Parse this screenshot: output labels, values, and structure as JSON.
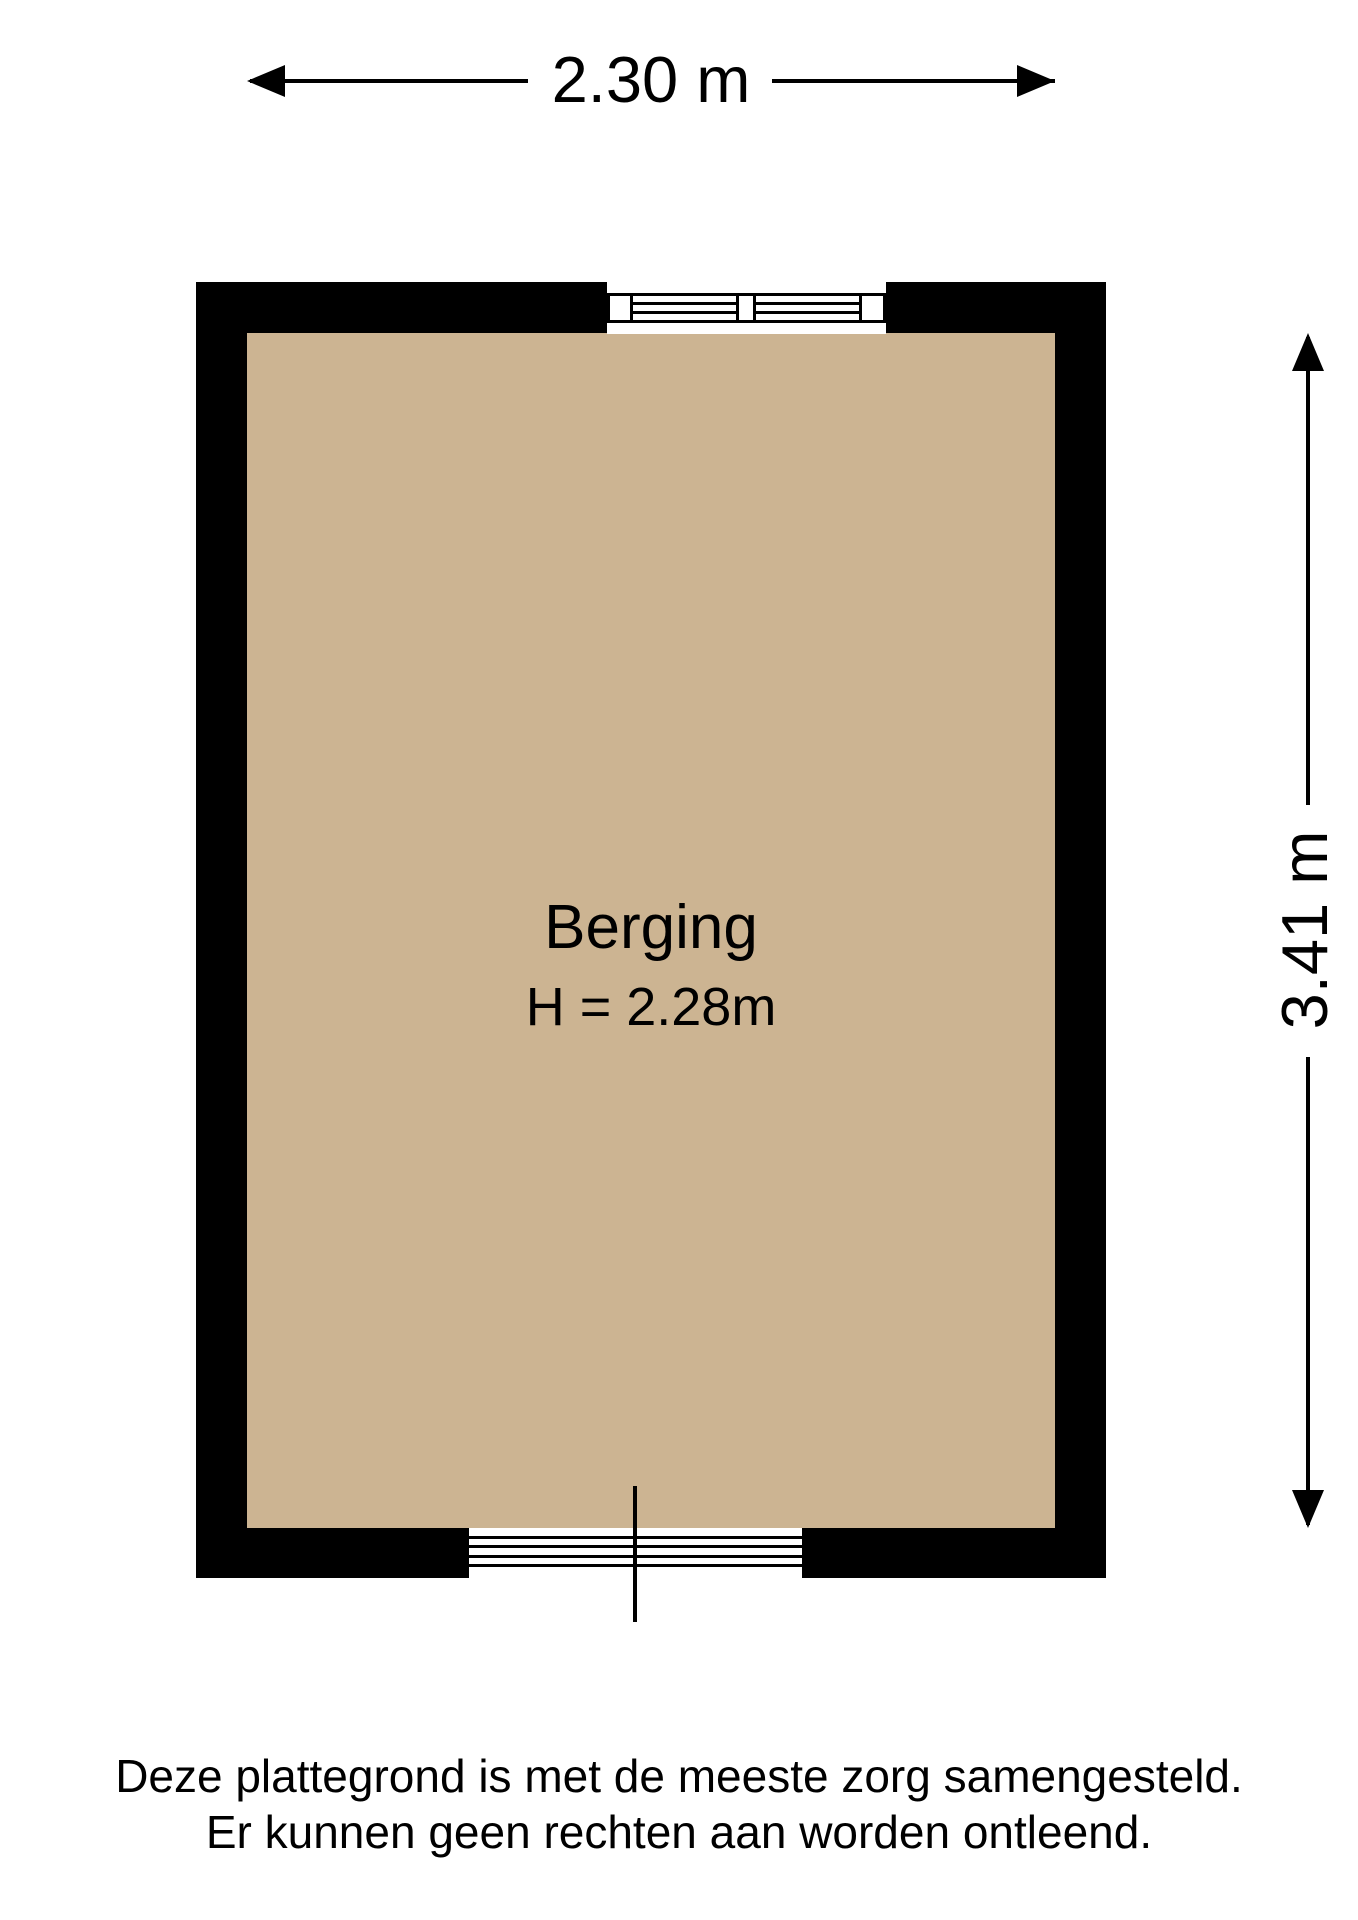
{
  "colors": {
    "background": "#ffffff",
    "wall": "#000000",
    "floor": "#ccb492",
    "line": "#000000",
    "text": "#000000"
  },
  "dimensions": {
    "width_label": "2.30 m",
    "depth_label": "3.41 m"
  },
  "room": {
    "name": "Berging",
    "ceiling_height_label": "H = 2.28m"
  },
  "disclaimer": {
    "line1": "Deze plattegrond is met de meeste zorg samengesteld.",
    "line2": "Er kunnen geen rechten aan worden ontleend."
  }
}
